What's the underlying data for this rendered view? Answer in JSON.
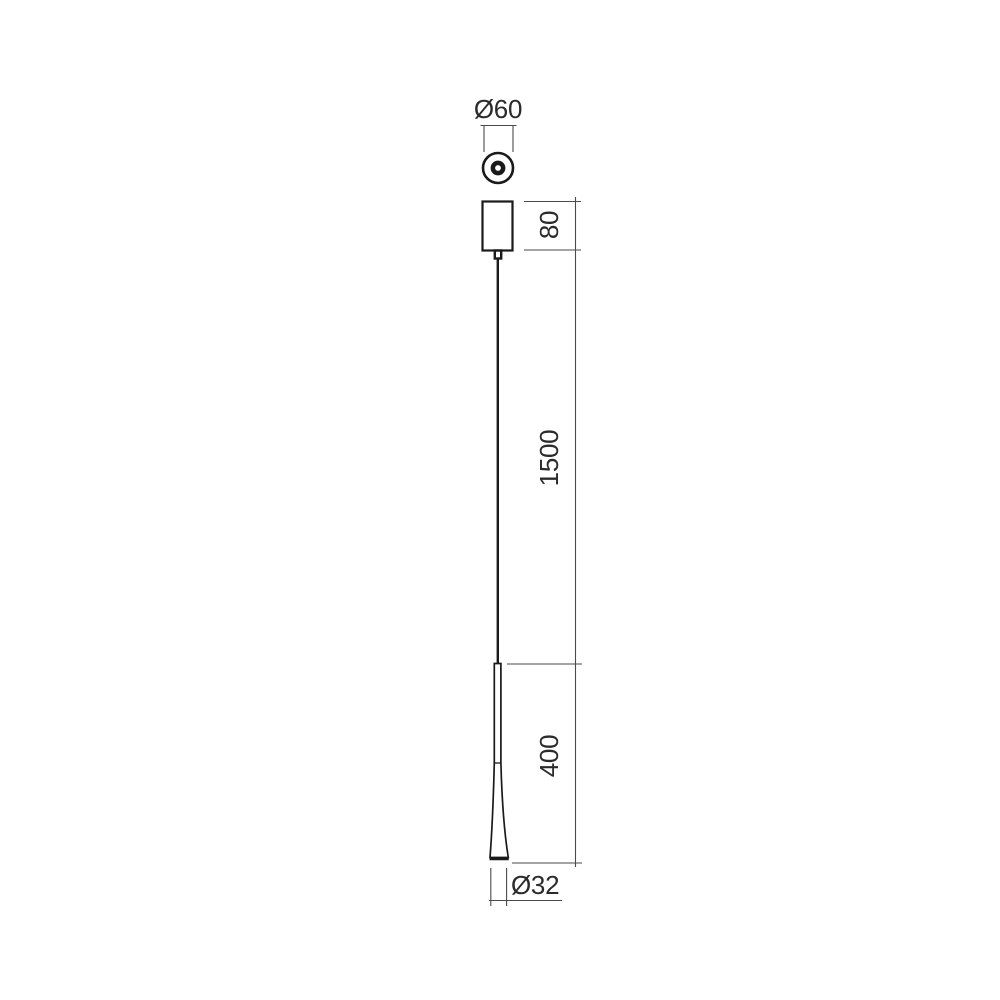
{
  "diagram": {
    "type": "technical-dimension-drawing",
    "views": {
      "top_view": "canopy-top-view-circle",
      "front_view": "pendant-front-view"
    },
    "dimensions": [
      {
        "id": "canopy-diameter",
        "label": "Ø60",
        "orientation": "horizontal",
        "position": "top"
      },
      {
        "id": "canopy-height",
        "label": "80",
        "orientation": "vertical",
        "position": "right"
      },
      {
        "id": "cable-length",
        "label": "1500",
        "orientation": "vertical",
        "position": "right"
      },
      {
        "id": "body-height",
        "label": "400",
        "orientation": "vertical",
        "position": "right"
      },
      {
        "id": "body-diameter",
        "label": "Ø32",
        "orientation": "horizontal",
        "position": "bottom"
      }
    ],
    "colors": {
      "background": "#ffffff",
      "object_line": "#1a1a1a",
      "dimension_line": "#4a4a4a",
      "text": "#2b2b2b"
    }
  }
}
